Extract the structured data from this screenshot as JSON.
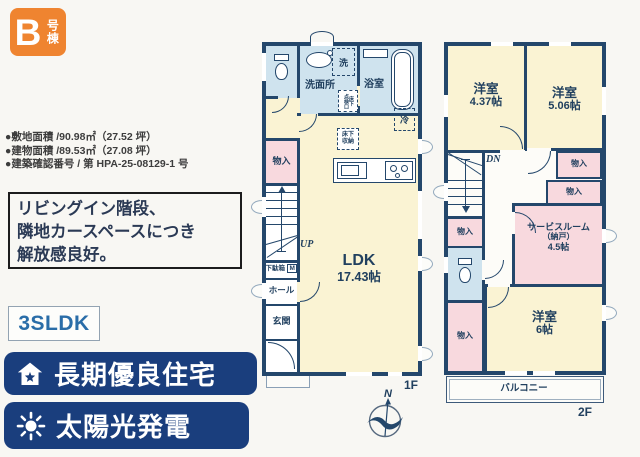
{
  "colors": {
    "wall": "#24476b",
    "cream": "#faf3d3",
    "blue_room": "#cfe3ee",
    "pink_room": "#f8d9de",
    "badge_orange": "#ef8430",
    "banner_navy": "#1a3e7d",
    "accent_blue": "#2a6da8"
  },
  "badge": {
    "letter": "B",
    "suffix": "号棟"
  },
  "specs": {
    "items": [
      "●敷地面積 /90.98㎡（27.52 坪）",
      "●建物面積 /89.53㎡（27.08 坪）",
      "●建築確認番号 / 第 HPA-25-08129-1 号"
    ]
  },
  "catchphrase": {
    "line1": "リビングイン階段、",
    "line2": "隣地カースペースにつき",
    "line3": "解放感良好。"
  },
  "plan_type": "3SLDK",
  "banners": {
    "b1": "長期優良住宅",
    "b2": "太陽光発電"
  },
  "floor1": {
    "label": "1F",
    "washroom": "洗面所",
    "laundry": "洗",
    "bath": "浴室",
    "fridge": "冷",
    "hatch_right": "床下",
    "hatch_left": "点検口",
    "underfloor_line1": "床下",
    "underfloor_line2": "収納",
    "closet": "物入",
    "shoe_cabinet": "下駄箱",
    "shoe_cabinet_m": "M",
    "hall": "ホール",
    "entrance": "玄関",
    "ldk_name": "LDK",
    "ldk_size": "17.43帖",
    "up": "UP"
  },
  "floor2": {
    "label": "2F",
    "dn": "DN",
    "room1_name": "洋室",
    "room1_size": "4.37帖",
    "room2_name": "洋室",
    "room2_size": "5.06帖",
    "closet": "物入",
    "service_name": "サービスルーム",
    "service_sub": "（納戸）",
    "service_size": "4.5帖",
    "room3_name": "洋室",
    "room3_size": "6帖",
    "balcony": "バルコニー"
  },
  "compass": {
    "north": "N"
  }
}
